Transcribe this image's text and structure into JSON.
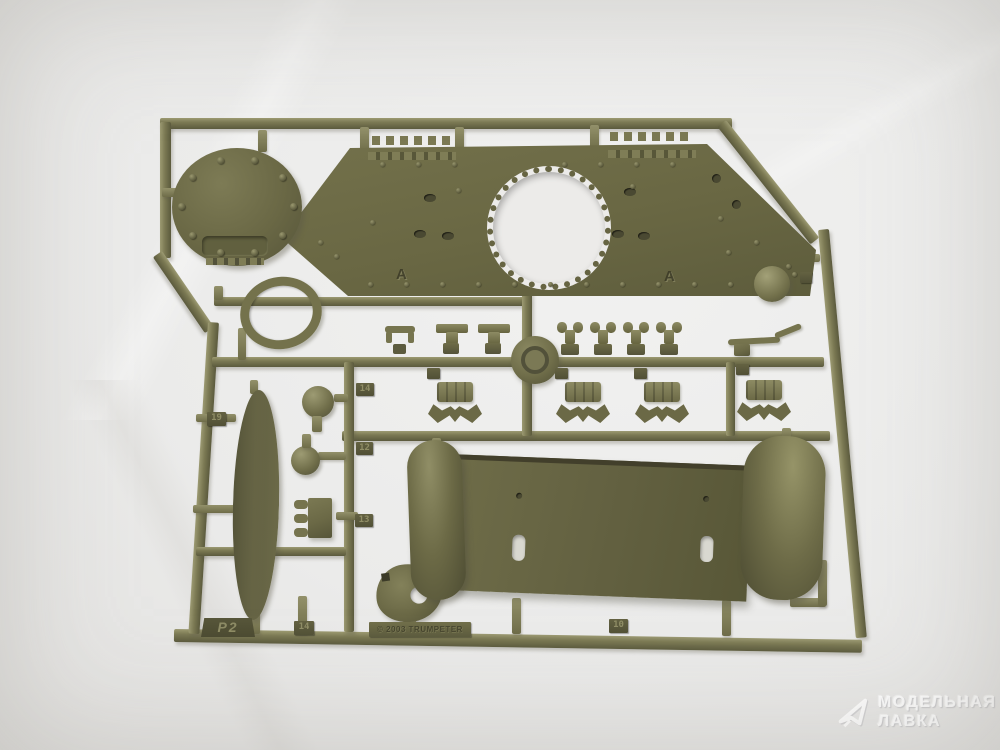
{
  "subject": {
    "kit_sprue_letter": "P2",
    "copyright": "© 2003 TRUMPETER",
    "panel_letters": [
      "A",
      "A"
    ],
    "part_tags": [
      "19",
      "14",
      "12",
      "13",
      "14",
      "10"
    ]
  },
  "watermark": {
    "line1": "МОДЕЛЬНАЯ",
    "line2": "ЛАВКА"
  },
  "colors": {
    "plastic": "#6b6946",
    "plastic_highlight": "#9c9a72",
    "plastic_shadow": "#504f35",
    "background": "#edeeef"
  }
}
